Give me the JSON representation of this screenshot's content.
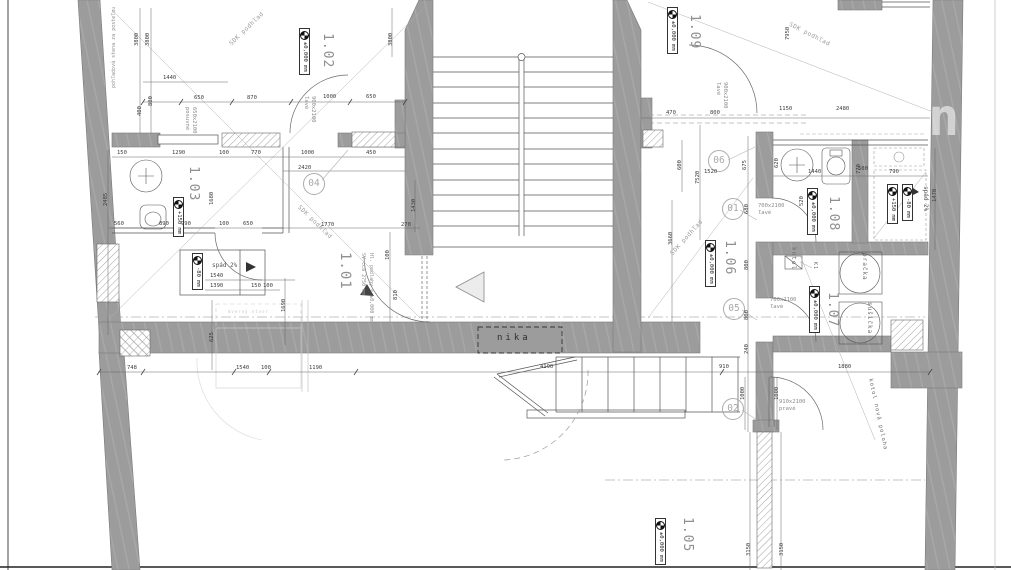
{
  "drawing": {
    "rooms": {
      "r101": {
        "number": "1.01",
        "height_note": "SV cca 2750 mm",
        "floor_note": "Hl. podlahy = ±0,000 mm"
      },
      "r102": {
        "number": "1.02",
        "level": "±0,000 mm"
      },
      "r103": {
        "number": "1.03",
        "level_floor": "+150 mm",
        "level_shower": "-80 mm",
        "slope_note": "spád 2%"
      },
      "r105": {
        "number": "1.05",
        "level": "±0,000 mm"
      },
      "r106": {
        "number": "1.06",
        "level": "±0,000 mm"
      },
      "r107": {
        "number": "1.07",
        "level": "±0,000 mm"
      },
      "r108": {
        "number": "1.08",
        "level": "±0,000 mm",
        "level_floor": "+150 mm",
        "level_shower": "-80 mm",
        "slope_note": "spád 2%"
      },
      "r109": {
        "number": "1.09",
        "level": "±0,000 mm"
      }
    },
    "position_markers": {
      "p01": "01",
      "p02": "02",
      "p04": "04",
      "p05": "05",
      "p06": "06"
    },
    "doors": {
      "d102": {
        "size": "900x2100",
        "swing": "ľavé"
      },
      "d103": {
        "size": "650x2100",
        "swing": "posuvné"
      },
      "d109": {
        "size": "900x2100",
        "swing": "ľavé"
      },
      "d108": {
        "size": "700x2100",
        "swing": "ľavé"
      },
      "d107": {
        "size": "700x2100",
        "swing": "ľavé"
      },
      "d105": {
        "size": "910x2100",
        "swing": "pravé"
      }
    },
    "equipment": {
      "boiler": "kotol",
      "boiler_tag": "K1",
      "washer": "pračka",
      "dryer": "sušička",
      "boiler_note": "kotol nová poloha"
    },
    "notes": {
      "niche": "nika",
      "ceiling": "SDK podhľad",
      "bed_wall": "pohľadová stena za posteľou",
      "faint_note": "dverný otvor"
    },
    "watermark": "n",
    "dims": [
      "1440",
      "650",
      "870",
      "1000",
      "650",
      "450",
      "150",
      "1290",
      "100",
      "770",
      "1000",
      "2420",
      "560",
      "890",
      "990",
      "100",
      "650",
      "1770",
      "270",
      "1540",
      "1390",
      "150",
      "100",
      "748",
      "1540",
      "100",
      "1190",
      "4190",
      "910",
      "1880",
      "470",
      "800",
      "1150",
      "2480",
      "1520",
      "1440",
      "790",
      "500",
      "3800",
      "3800",
      "3800",
      "800",
      "400",
      "2485",
      "1680",
      "1430",
      "100",
      "810",
      "625",
      "1690",
      "7950",
      "7520",
      "600",
      "3660",
      "680",
      "800",
      "800",
      "240",
      "1000",
      "1000",
      "770",
      "1470",
      "520",
      "620",
      "675",
      "3150",
      "3150"
    ]
  }
}
